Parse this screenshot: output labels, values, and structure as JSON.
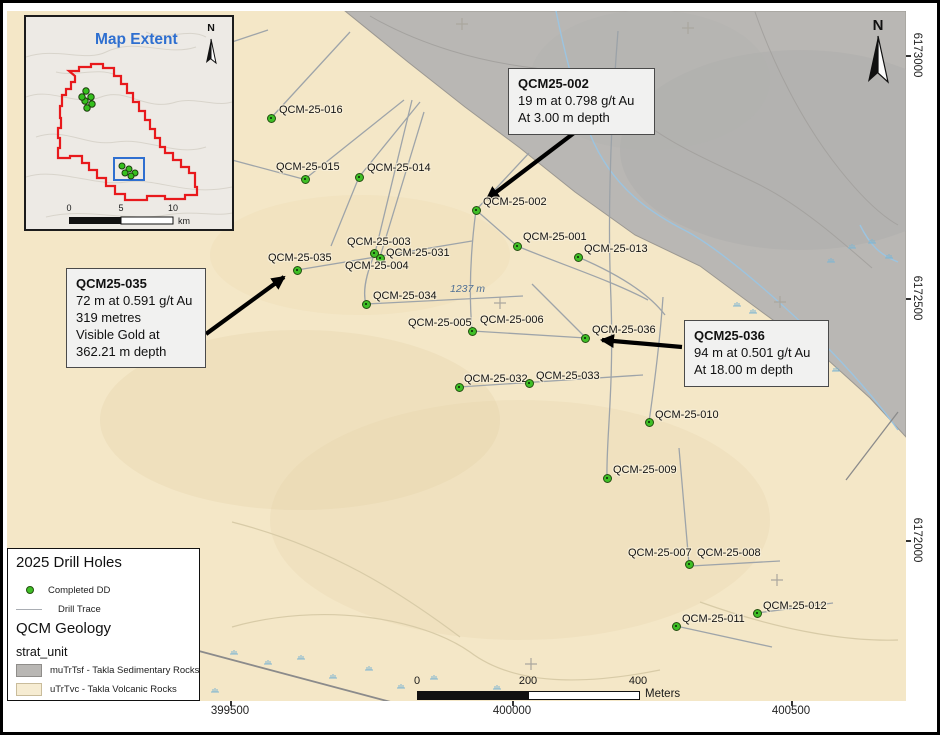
{
  "map": {
    "spot_elevation": "1237 m",
    "north_label": "N",
    "scalebar": {
      "t0": "0",
      "t1": "200",
      "t2": "400",
      "unit": "Meters"
    },
    "axis": {
      "bottom": [
        "399500",
        "400000",
        "400500"
      ],
      "right": [
        "6173000",
        "6172500",
        "6172000"
      ]
    },
    "inset": {
      "title": "Map Extent",
      "north_label": "N",
      "scale": {
        "t0": "0",
        "t1": "5",
        "t2": "10",
        "unit": "km"
      }
    }
  },
  "holes": [
    {
      "id": "QCM-25-016",
      "dot": [
        271,
        118
      ],
      "label": [
        279,
        104
      ]
    },
    {
      "id": "QCM-25-015",
      "dot": [
        305,
        179
      ],
      "label": [
        276,
        161
      ]
    },
    {
      "id": "QCM-25-014",
      "dot": [
        359,
        177
      ],
      "label": [
        367,
        162
      ]
    },
    {
      "id": "QCM-25-002",
      "dot": [
        476,
        210
      ],
      "label": [
        483,
        196
      ]
    },
    {
      "id": "QCM-25-001",
      "dot": [
        517,
        246
      ],
      "label": [
        523,
        231
      ]
    },
    {
      "id": "QCM-25-013",
      "dot": [
        578,
        257
      ],
      "label": [
        584,
        243
      ]
    },
    {
      "id": "QCM-25-003",
      "dot": [
        374,
        253
      ],
      "label": [
        347,
        236
      ]
    },
    {
      "id": "QCM-25-031",
      "dot": [
        380,
        258
      ],
      "label": [
        386,
        247
      ]
    },
    {
      "id": "QCM-25-004",
      "dot": null,
      "label": [
        345,
        260
      ]
    },
    {
      "id": "QCM-25-035",
      "dot": [
        297,
        270
      ],
      "label": [
        268,
        252
      ]
    },
    {
      "id": "QCM-25-034",
      "dot": [
        366,
        304
      ],
      "label": [
        373,
        290
      ]
    },
    {
      "id": "QCM-25-005",
      "dot": [
        472,
        331
      ],
      "label": [
        408,
        317
      ]
    },
    {
      "id": "QCM-25-006",
      "dot": null,
      "label": [
        480,
        314
      ]
    },
    {
      "id": "QCM-25-036",
      "dot": [
        585,
        338
      ],
      "label": [
        592,
        324
      ]
    },
    {
      "id": "QCM-25-032",
      "dot": [
        459,
        387
      ],
      "label": [
        464,
        373
      ]
    },
    {
      "id": "QCM-25-033",
      "dot": [
        529,
        383
      ],
      "label": [
        536,
        370
      ]
    },
    {
      "id": "QCM-25-010",
      "dot": [
        649,
        422
      ],
      "label": [
        655,
        409
      ]
    },
    {
      "id": "QCM-25-009",
      "dot": [
        607,
        478
      ],
      "label": [
        613,
        464
      ]
    },
    {
      "id": "QCM-25-007",
      "dot": [
        689,
        564
      ],
      "label": [
        628,
        547
      ]
    },
    {
      "id": "QCM-25-008",
      "dot": null,
      "label": [
        697,
        547
      ]
    },
    {
      "id": "QCM-25-011",
      "dot": [
        676,
        626
      ],
      "label": [
        682,
        613
      ]
    },
    {
      "id": "QCM-25-012",
      "dot": [
        757,
        613
      ],
      "label": [
        763,
        600
      ]
    }
  ],
  "callouts": [
    {
      "title": "QCM25-002",
      "lines": [
        "19 m at 0.798 g/t Au",
        "At 3.00 m depth"
      ]
    },
    {
      "title": "QCM25-035",
      "lines": [
        "72 m at 0.591 g/t Au",
        "319 metres",
        "Visible Gold at",
        "362.21 m depth"
      ]
    },
    {
      "title": "QCM25-036",
      "lines": [
        "94 m at 0.501 g/t Au",
        "At 18.00 m depth"
      ]
    }
  ],
  "legend": {
    "drill_title": "2025 Drill Holes",
    "completed_dd": "Completed DD",
    "drill_trace": "Drill Trace",
    "geology_title": "QCM Geology",
    "strat_unit": "strat_unit",
    "sed_label": "muTrTsf - Takla Sedimentary Rocks",
    "volc_label": "uTrTvc - Takla Volcanic Rocks"
  },
  "colors": {
    "volcanic": "#f4e7c7",
    "sedimentary": "#b9b7b4",
    "dot_green": "#3fbf26",
    "extent_red": "#e8191c",
    "extent_blue": "#2e6fd0"
  }
}
